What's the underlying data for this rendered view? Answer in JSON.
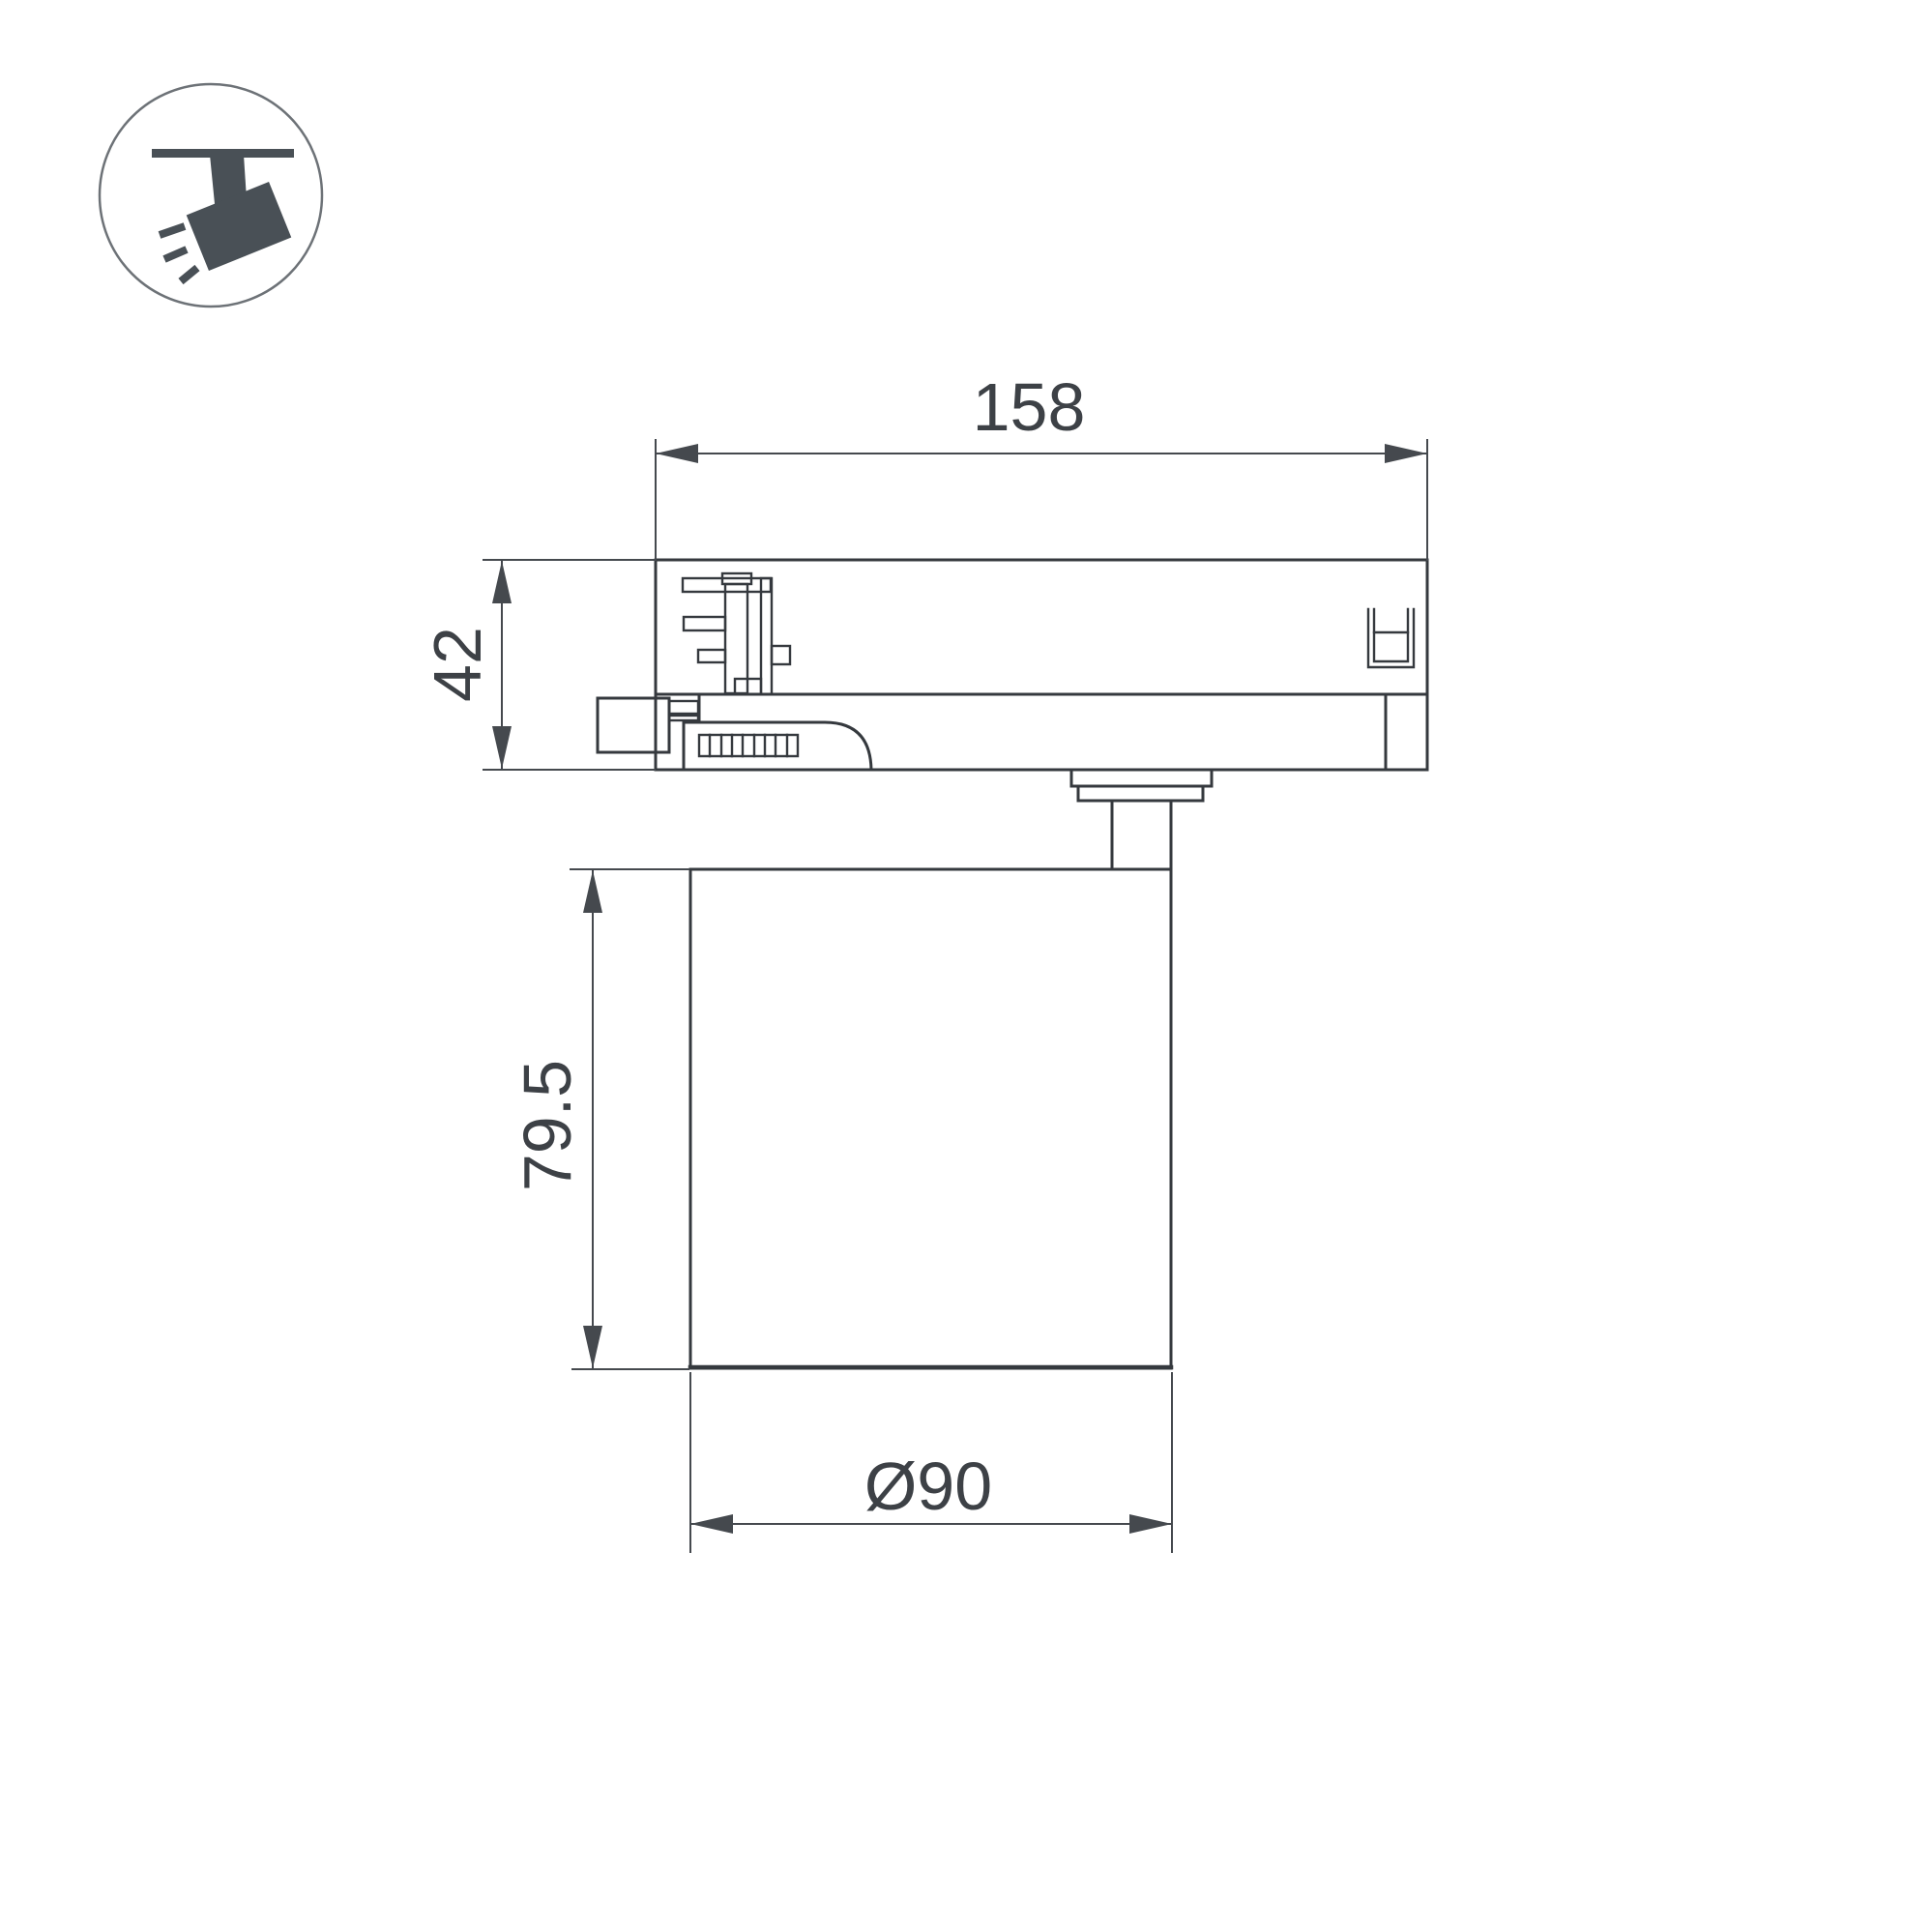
{
  "drawing": {
    "icon": {
      "name": "track-spotlight-icon"
    },
    "dimensions": {
      "adapter_length": "158",
      "adapter_height": "42",
      "body_height": "79.5",
      "body_diameter": "Ø90"
    },
    "colors": {
      "background": "#ffffff",
      "part_line": "#35393e",
      "dimension_line": "#45494e",
      "label_text": "#3d4146",
      "icon_fill": "#495056",
      "icon_circle_stroke": "#6d7277"
    }
  }
}
